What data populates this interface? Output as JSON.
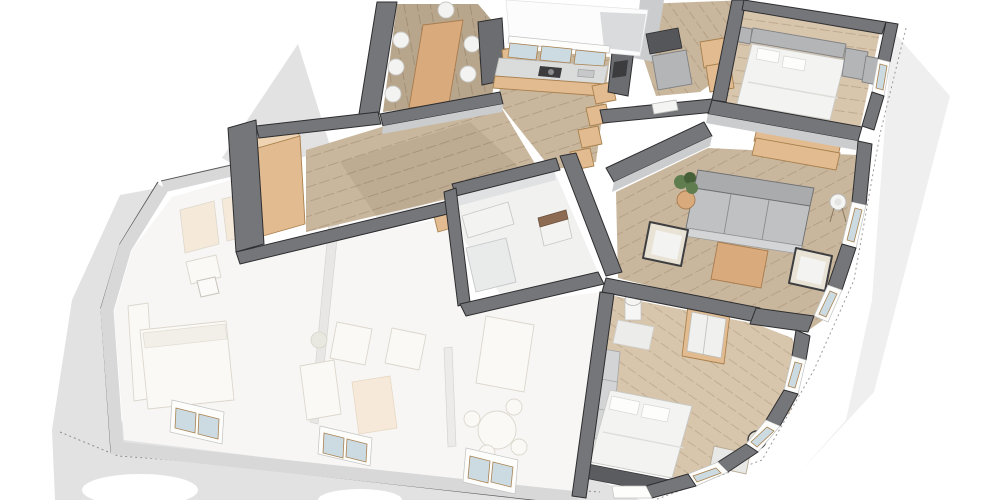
{
  "meta": {
    "kind": "3d-floor-plan-render",
    "view": "axonometric-top",
    "visible_text": "none"
  },
  "canvas": {
    "width": 1000,
    "height": 500
  },
  "colors": {
    "bg": "#ffffff",
    "ground": "#e2e2e3",
    "ground_light": "#efeff0",
    "wall_cut": "#75767a",
    "wall_edge": "#2e2e30",
    "wall_face": "#cbccce",
    "ghost_wall": "#d8d8d9",
    "ghost_wall_edge": "#a3a3a5",
    "ghost_room": "#f7f6f4",
    "ghost_furniture": "#faf9f6",
    "ghost_furniture_edge": "#ddd7cd",
    "ghost_accent": "#f5ead9",
    "floor_wood": "#c9b79d",
    "floor_wood_dark": "#b8a68c",
    "floor_wood_light": "#d7c5ac",
    "floor_bath": "#f1f1f0",
    "furn_tan": "#e2bc90",
    "furn_tan_light": "#eed4b2",
    "furn_wood": "#d8aa7c",
    "frame_tan": "#a9814f",
    "sofa_gray": "#c0c1c3",
    "sofa_gray_dark": "#aaabad",
    "white_furn": "#f3f3f1",
    "gray_furn": "#b4b5b7",
    "dark_furn": "#5b5c5f",
    "chair_dark": "#3f3f41",
    "cushion": "#e9e3d6",
    "plant_green": "#5f7d4f",
    "plant_green_dark": "#46613a",
    "glass": "#ccdbe1",
    "lamp_white": "#f4f4f2"
  },
  "building": {
    "sections": [
      {
        "name": "apartment",
        "style": "rendered"
      },
      {
        "name": "neighboring-unit",
        "style": "ghosted-white"
      }
    ]
  },
  "apartment": {
    "rooms": [
      {
        "name": "dining-room",
        "furniture": [
          "dining-table",
          "dining-chairs-x7",
          "tall-cabinet",
          "shelf"
        ]
      },
      {
        "name": "kitchen",
        "furniture": [
          "window-band",
          "counter",
          "cooktop",
          "sink",
          "cabinet-fronts",
          "oven-column",
          "open-shelf-steps-x4"
        ]
      },
      {
        "name": "utility-room",
        "furniture": [
          "dark-counter",
          "appliance",
          "shelf-boxes-x2",
          "door"
        ]
      },
      {
        "name": "master-bedroom",
        "furniture": [
          "double-bed",
          "pillows-x2",
          "headboard",
          "nightstand",
          "wardrobe-cabinets-x2",
          "foot-bench",
          "wall-window"
        ]
      },
      {
        "name": "hallway",
        "furniture": [
          "tall-wardrobe",
          "doormat"
        ]
      },
      {
        "name": "bathroom",
        "furniture": [
          "cabinet-row",
          "vanity",
          "shower-tray"
        ]
      },
      {
        "name": "living-room",
        "furniture": [
          "sofa-3-seat",
          "coffee-table",
          "armchair-left",
          "armchair-right",
          "side-table",
          "potted-plant",
          "floor-lamp",
          "sideboard",
          "window-bays-x2"
        ]
      },
      {
        "name": "bedroom-2",
        "furniture": [
          "bed",
          "pillows-x2",
          "wardrobe-white-doors",
          "column-cylinder",
          "corner-shelf",
          "headboard-panels",
          "foot-bench",
          "desk",
          "chair",
          "window-bays-x3"
        ]
      }
    ]
  },
  "ghost_unit": {
    "rooms": [
      {
        "name": "bedroom",
        "furniture": [
          "bed",
          "couch-blocks",
          "closet-row",
          "desk",
          "chair"
        ]
      },
      {
        "name": "living-kitchen",
        "furniture": [
          "armchairs-x2",
          "coffee-table",
          "sofa-block",
          "kitchen-island",
          "round-dining-table",
          "chairs-x4",
          "plant"
        ]
      }
    ],
    "window_count": 3
  }
}
